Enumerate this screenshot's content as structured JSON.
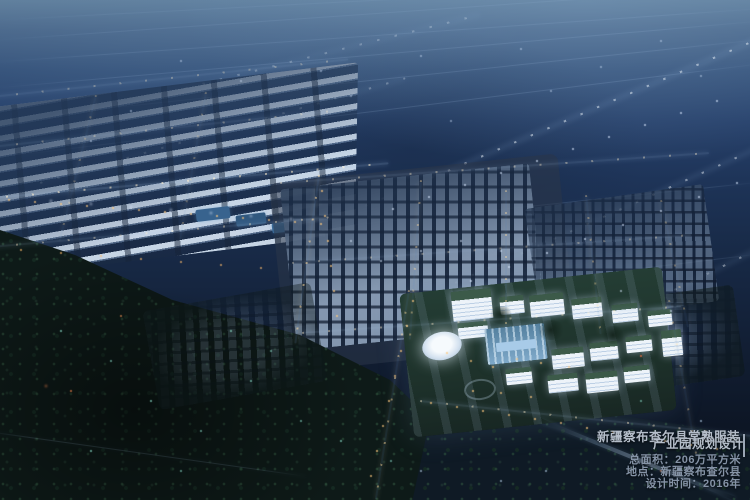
{
  "overlay": {
    "title_line1": "新疆察布查尔县常熟服装",
    "title_line2": "产业园规划设计",
    "area_line": "总面积：206万平方米",
    "location_line": "地点：新疆察布查尔县",
    "year_line": "设计时间：2016年"
  },
  "colors": {
    "ground_dark": "#0c1522",
    "sky_top": "#607f9c",
    "building_white": "#edf3f9",
    "roof_green": "#3c5a49",
    "glass_blue": "#a8cbe8",
    "street_light_warm": "#ffc97e",
    "street_light_cool": "#d8e8ff",
    "title_text": "#b4bdc9",
    "info_text": "#8593a6"
  }
}
